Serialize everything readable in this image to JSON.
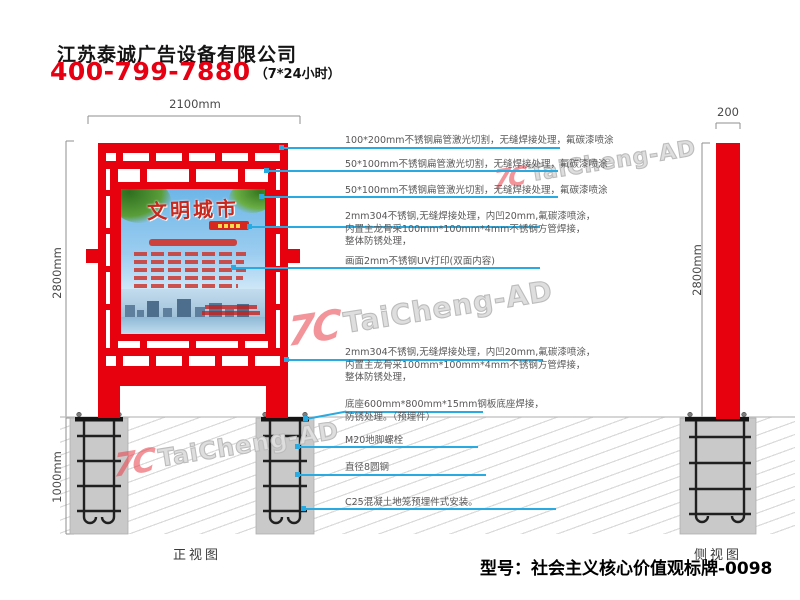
{
  "header": {
    "company": "江苏泰诚广告设备有限公司",
    "hotline": "400-799-7880",
    "hotline_note": "（7*24小时）"
  },
  "front_view": {
    "caption": "正视图",
    "dim_width": "2100mm",
    "dim_height": "2800mm",
    "dim_foundation": "1000mm",
    "poster_title": "文明城市"
  },
  "side_view": {
    "caption": "侧视图",
    "dim_width": "200",
    "dim_height": "2800mm"
  },
  "annotations": [
    {
      "lines": [
        "100*200mm不锈钢扁管激光切割，无缝焊接处理，氟碳漆喷涂"
      ]
    },
    {
      "lines": [
        "50*100mm不锈钢扁管激光切割，无缝焊接处理，氟碳漆喷涂"
      ]
    },
    {
      "lines": [
        "50*100mm不锈钢扁管激光切割，无缝焊接处理，氟碳漆喷涂"
      ]
    },
    {
      "lines": [
        "2mm304不锈钢,无缝焊接处理，内凹20mm,氟碳漆喷涂，",
        "内置主龙骨采100mm*100mm*4mm不锈钢方管焊接，",
        "整体防锈处理，"
      ]
    },
    {
      "lines": [
        "画面2mm不锈钢UV打印(双面内容)"
      ]
    },
    {
      "lines": [
        "2mm304不锈钢,无缝焊接处理，内凹20mm,氟碳漆喷涂，",
        "内置主龙骨采100mm*100mm*4mm不锈钢方管焊接，",
        "整体防锈处理，"
      ]
    },
    {
      "lines": [
        "底座600mm*800mm*15mm钢板底座焊接，",
        "防锈处理。（预埋件）"
      ]
    },
    {
      "lines": [
        "M20地脚螺栓"
      ]
    },
    {
      "lines": [
        "直径8圆钢"
      ]
    },
    {
      "lines": [
        "C25混凝土地笼预埋件式安装。"
      ]
    }
  ],
  "watermark": {
    "logo": "7C",
    "text": "TaiCheng-AD"
  },
  "footer": {
    "model": "型号：社会主义核心价值观标牌-0098"
  },
  "colors": {
    "red": "#e60012",
    "leader_blue": "#29abe2",
    "concrete": "#c9c9c9",
    "annotation_text": "#595757"
  }
}
